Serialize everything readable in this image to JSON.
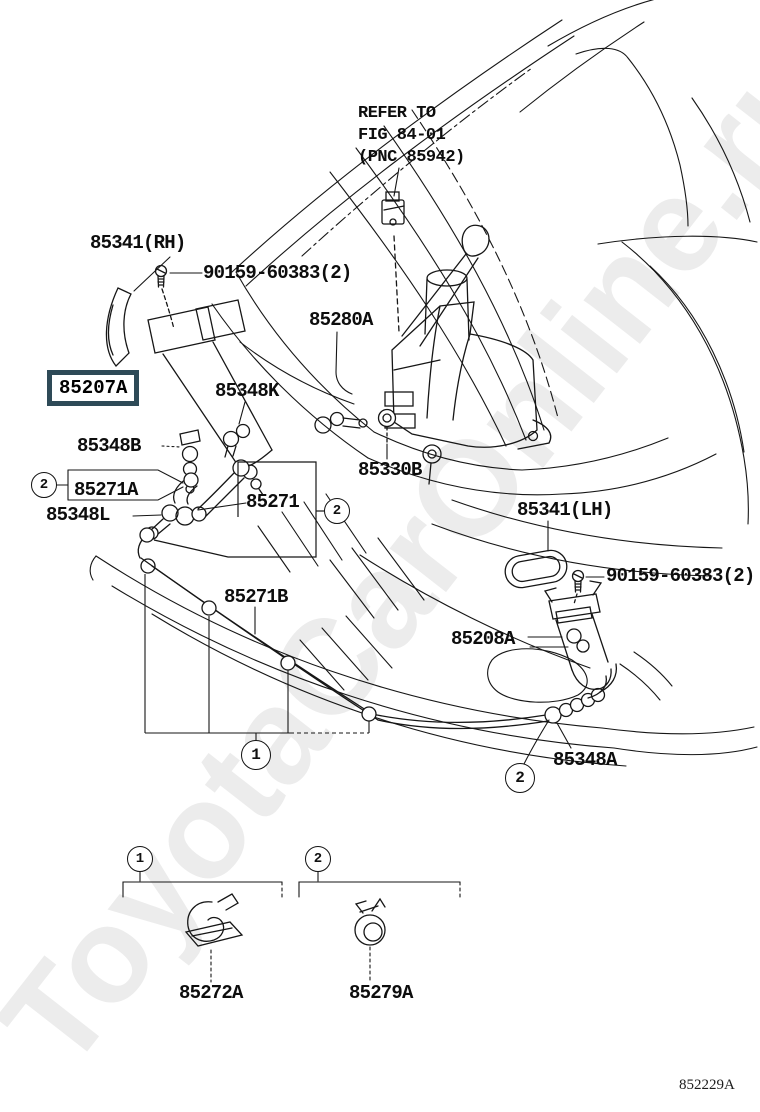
{
  "watermark": "ToyotaCarOnline.ru",
  "diagram_number": "852229A",
  "note": {
    "line1": "REFER TO",
    "line2": "FIG 84-01",
    "line3": "(PNC 85942)"
  },
  "highlight_color": "#2e4a57",
  "labels": {
    "p85341rh": "85341(RH)",
    "p90159": "90159-60383(2)",
    "p85280a": "85280A",
    "p85207a": "85207A",
    "p85348k": "85348K",
    "p85348b": "85348B",
    "p85271a": "85271A",
    "p85271": "85271",
    "p85348l": "85348L",
    "p85330b": "85330B",
    "p85341lh": "85341(LH)",
    "p85271b": "85271B",
    "p85208a": "85208A",
    "p85348a": "85348A",
    "p85272a": "85272A",
    "p85279a": "85279A"
  },
  "callouts": {
    "one": "1",
    "two": "2"
  }
}
